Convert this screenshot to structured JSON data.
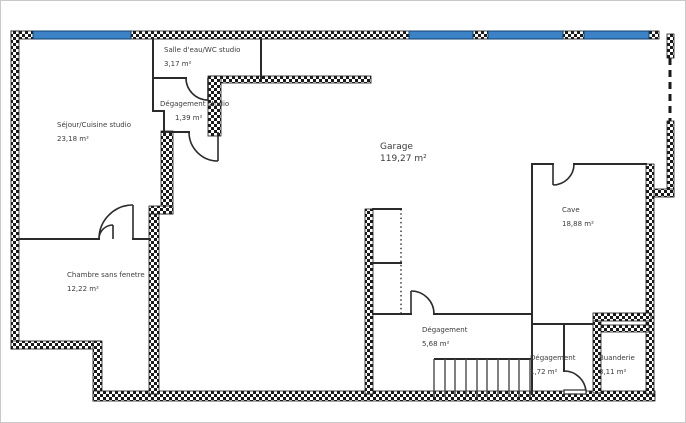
{
  "title": "Basement floor plan",
  "colors": {
    "wall": "#1a1a1a",
    "thin_wall": "#2b2b2b",
    "window": "#3b82c6",
    "text": "#3c3c3c",
    "background": "#ffffff"
  },
  "rooms": [
    {
      "id": "salle-eau-studio",
      "name": "Salle d'eau/WC studio",
      "area": "3,17 m²"
    },
    {
      "id": "degagement-studio",
      "name": "Dégagement studio",
      "area": "1,39 m²"
    },
    {
      "id": "sejour-cuisine-studio",
      "name": "Séjour/Cuisine studio",
      "area": "23,18 m²"
    },
    {
      "id": "chambre-sans-fenetre",
      "name": "Chambre sans fenetre",
      "area": "12,22 m²"
    },
    {
      "id": "garage",
      "name": "Garage",
      "area": "119,27 m²"
    },
    {
      "id": "cave",
      "name": "Cave",
      "area": "18,88 m²"
    },
    {
      "id": "degagement-sous-sol",
      "name": "Dégagement",
      "area": "5,68 m²"
    },
    {
      "id": "degagement-2",
      "name": "Dégagement",
      "area": "1,72 m²"
    },
    {
      "id": "buanderie",
      "name": "Buanderie",
      "area": "3,11 m²"
    }
  ],
  "staircase": {
    "treads": 10
  },
  "windows_count": 4
}
